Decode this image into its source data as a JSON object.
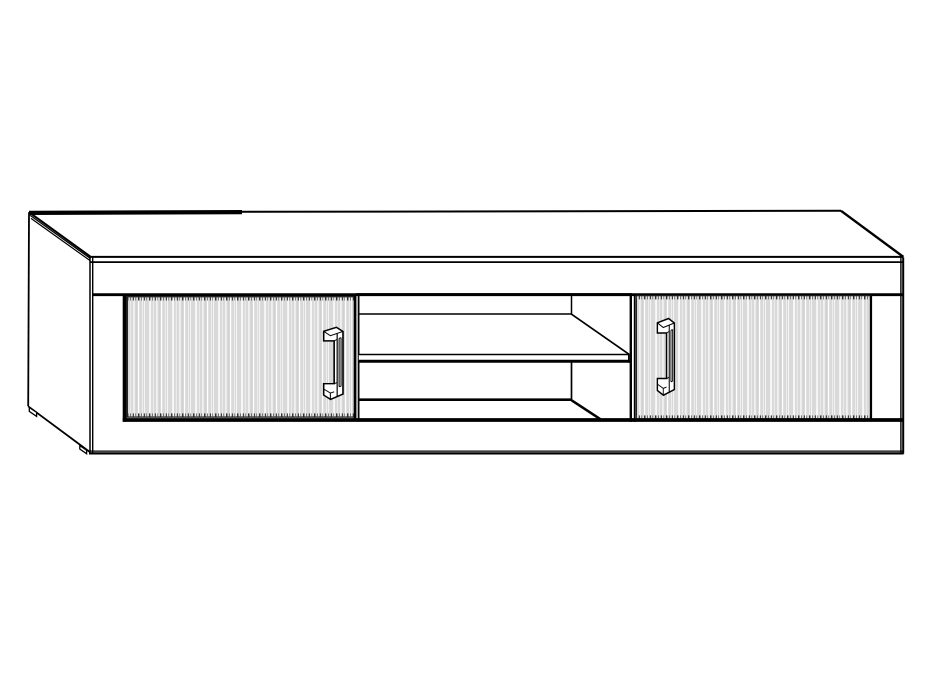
{
  "meta": {
    "description": "Black-and-white technical line drawing of a low TV cabinet (lowboard) shown in front-left perspective: two doors with vertical wood-grain shading and vertical bar handles, an open middle compartment with one shelf, a top panel, left side panel, bottom plinth rail and two small feet under the left side.",
    "canvas_width": 928,
    "canvas_height": 696
  },
  "colors": {
    "background": "#ffffff",
    "line": "#000000",
    "panel_fill": "#ffffff",
    "door_fill": "#d9d9d9",
    "door_streak_light": "#ffffff",
    "door_streak_mid": "#f1f1f1",
    "door_streak_dark": "#c9c9c9",
    "edge_tick": "#2f2f2f"
  },
  "parts": {
    "top_panel": "top panel seen in perspective",
    "left_side_panel": "left side panel",
    "front_frame": "front carcass frame with top rail and bottom plinth rail",
    "left_door": "left door with vertical grain texture",
    "left_door_handle": "vertical bar handle on left door",
    "open_compartment": "open middle compartment with interior back and right wall lines",
    "shelf": "middle shelf inside open compartment",
    "right_door": "right door with vertical grain texture",
    "right_door_handle": "vertical bar handle on right door",
    "back_left_foot": "small foot under back left corner",
    "front_left_foot": "small foot under front left corner"
  }
}
